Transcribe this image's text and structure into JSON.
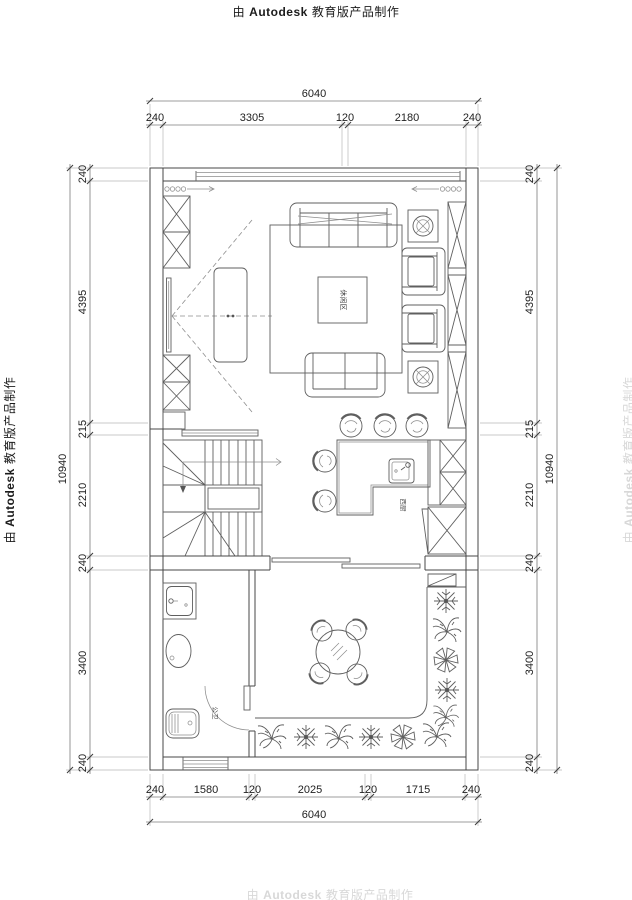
{
  "stamp": {
    "prefix": "由",
    "brand": "Autodesk",
    "suffix": "教育版产品制作"
  },
  "dimensions": {
    "top": {
      "overall": "6040",
      "segments": [
        "240",
        "3305",
        "120",
        "2180",
        "240"
      ]
    },
    "bottom": {
      "overall": "6040",
      "segments": [
        "240",
        "1580",
        "120",
        "2025",
        "120",
        "1715",
        "240"
      ]
    },
    "left": {
      "overall": "10940",
      "segments": [
        "240",
        "4395",
        "215",
        "2210",
        "240",
        "3400",
        "240"
      ]
    },
    "right": {
      "overall": "10940",
      "segments": [
        "240",
        "4395",
        "215",
        "2210",
        "240",
        "3400",
        "240"
      ]
    }
  },
  "room_labels": {
    "lounge": "休闲区",
    "west_kitchen": "西厨",
    "bathroom": "公卫"
  },
  "colors": {
    "wall_line": "#474747",
    "furniture_line": "#5f5f5f",
    "dim_text": "#222222",
    "stamp_text": "#1c1c1c",
    "faint_stamp": "#d8d8d8",
    "background": "#ffffff"
  }
}
